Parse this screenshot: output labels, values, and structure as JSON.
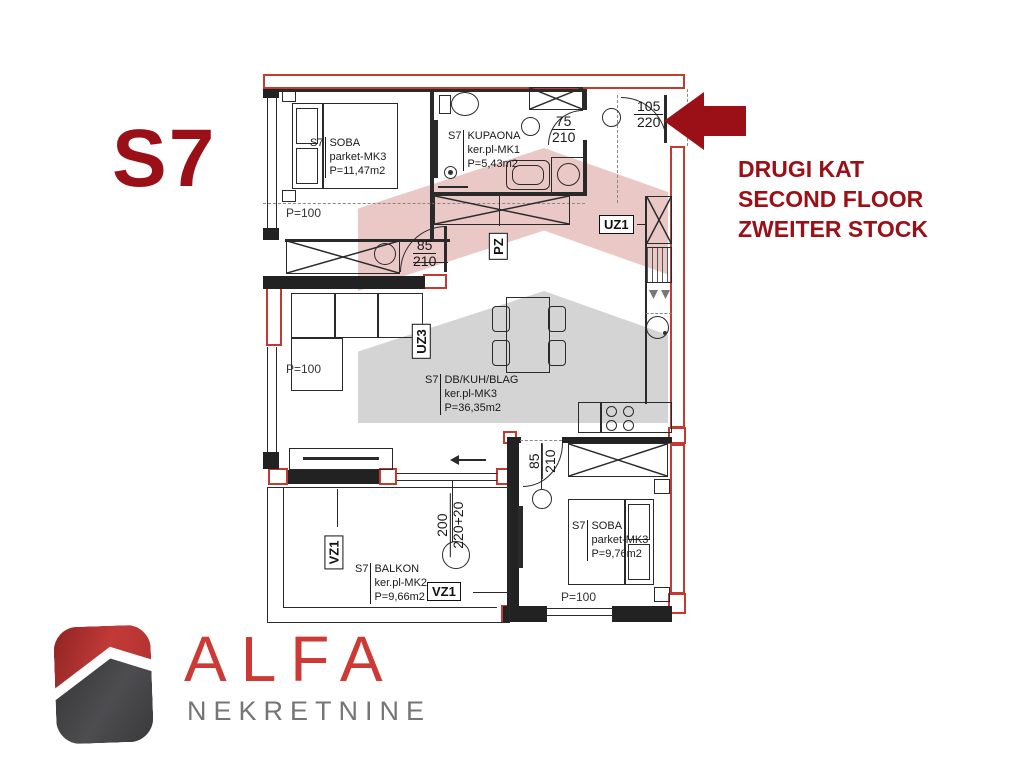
{
  "unit": {
    "label": "S7"
  },
  "floor_info": {
    "line1": "DRUGI KAT",
    "line2": "SECOND FLOOR",
    "line3": "ZWEITER STOCK"
  },
  "rooms": [
    {
      "prefix": "S7",
      "name": "SOBA",
      "floor": "parket-MK3",
      "area": "P=11,47m2"
    },
    {
      "prefix": "S7",
      "name": "KUPAONA",
      "floor": "ker.pl-MK1",
      "area": "P=5,43m2"
    },
    {
      "prefix": "S7",
      "name": "DB/KUH/BLAG",
      "floor": "ker.pl-MK3",
      "area": "P=36,35m2"
    },
    {
      "prefix": "S7",
      "name": "BALKON",
      "floor": "ker.pl-MK2",
      "area": "P=9,66m2"
    },
    {
      "prefix": "S7",
      "name": "SOBA",
      "floor": "parket-MK3",
      "area": "P=9,76m2"
    }
  ],
  "dimensions": {
    "entrance_door": {
      "top": "105",
      "bottom": "220"
    },
    "bathroom_door": {
      "top": "75",
      "bottom": "210"
    },
    "bedroom1_door": {
      "top": "85",
      "bottom": "210"
    },
    "bedroom2_door": {
      "top": "85",
      "bottom": "210"
    },
    "balcony_door": {
      "top": "200",
      "bottom": "220+20"
    },
    "parapet_bedroom1": "P=100",
    "parapet_living": "P=100",
    "parapet_bedroom2": "P=100"
  },
  "zones": {
    "uz1": "UZ1",
    "uz3": "UZ3",
    "pz": "PZ",
    "vz1_wall": "VZ1",
    "vz1_floor": "VZ1"
  },
  "logo": {
    "title": "ALFA",
    "subtitle": "NEKRETNINE"
  },
  "colors": {
    "accent_dark_red": "#9A1016",
    "wall_red": "#C23B32",
    "logo_red": "#CE3B37",
    "logo_gray": "#757575"
  }
}
